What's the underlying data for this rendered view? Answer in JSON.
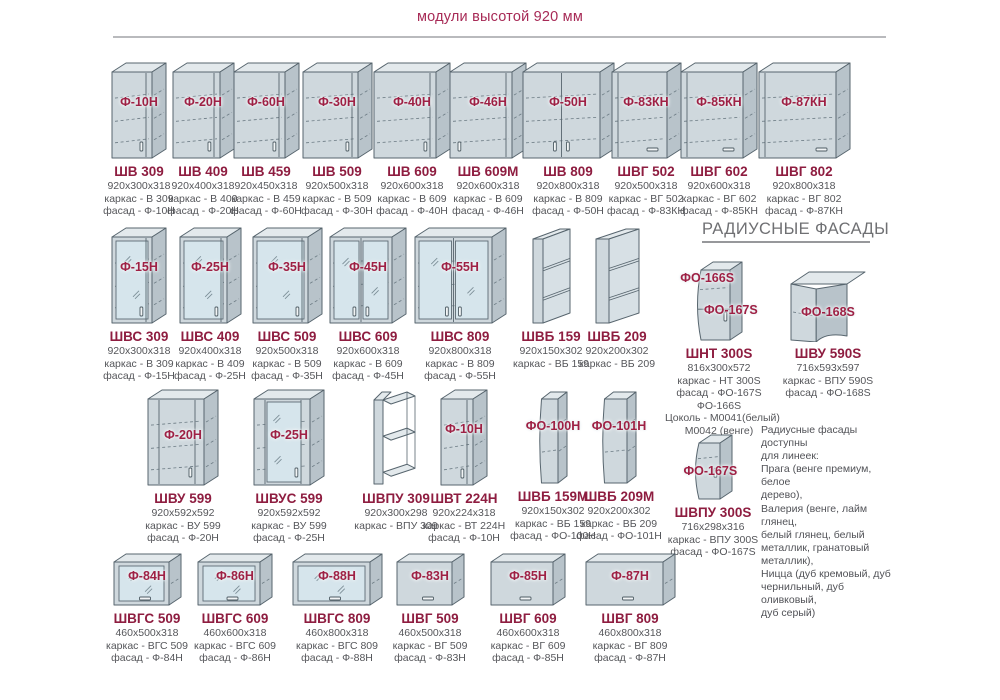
{
  "header": {
    "title": "модули высотой 920 мм"
  },
  "section": {
    "radius_heading": "РАДИУСНЫЕ ФАСАДЫ"
  },
  "colors": {
    "accent_maroon": "#8e1d40",
    "title_pink": "#a72a56",
    "spec_gray": "#55565a",
    "heading_gray": "#6f7073",
    "cabinet_fill": "#cfd8dd",
    "cabinet_side": "#b8c3ca",
    "glass_fill": "#d6e5ec"
  },
  "note": {
    "lines": [
      "Радиусные фасады доступны",
      "для линеек:",
      "Прага (венге премиум, белое",
      "дерево),",
      "Валерия (венге, лайм глянец,",
      "белый глянец, белый",
      "металлик, гранатовый",
      "металлик),",
      "Ницца (дуб кремовый, дуб",
      "чернильный, дуб оливковый,",
      "дуб серый)"
    ]
  },
  "modules": [
    {
      "code": "ШВ 309",
      "specs": [
        "920x300x318",
        "каркас - В 309",
        "фасад - Ф-10Н"
      ],
      "facades": [
        "Ф-10Н"
      ],
      "art": "cabinet-single-door"
    },
    {
      "code": "ШВ 409",
      "specs": [
        "920x400x318",
        "каркас - В 409",
        "фасад - Ф-20Н"
      ],
      "facades": [
        "Ф-20Н"
      ],
      "art": "cabinet-single-door"
    },
    {
      "code": "ШВ 459",
      "specs": [
        "920x450x318",
        "каркас - В 459",
        "фасад - Ф-60Н"
      ],
      "facades": [
        "Ф-60Н"
      ],
      "art": "cabinet-single-door"
    },
    {
      "code": "ШВ 509",
      "specs": [
        "920x500x318",
        "каркас - В 509",
        "фасад - Ф-30Н"
      ],
      "facades": [
        "Ф-30Н"
      ],
      "art": "cabinet-single-door"
    },
    {
      "code": "ШВ 609",
      "specs": [
        "920x600x318",
        "каркас - В 609",
        "фасад - Ф-40Н"
      ],
      "facades": [
        "Ф-40Н"
      ],
      "art": "cabinet-single-door"
    },
    {
      "code": "ШВ 609М",
      "specs": [
        "920x600x318",
        "каркас - В 609",
        "фасад - Ф-46Н"
      ],
      "facades": [
        "Ф-46Н"
      ],
      "art": "cabinet-single-door-left-handle"
    },
    {
      "code": "ШВ 809",
      "specs": [
        "920x800x318",
        "каркас - В 809",
        "фасад - Ф-50Н"
      ],
      "facades": [
        "Ф-50Н"
      ],
      "art": "cabinet-double-door"
    },
    {
      "code": "ШВГ 502",
      "specs": [
        "920x500x318",
        "каркас - ВГ 502",
        "фасад - Ф-83КН"
      ],
      "facades": [
        "Ф-83КН"
      ],
      "art": "cabinet-door-horizontal-handle"
    },
    {
      "code": "ШВГ 602",
      "specs": [
        "920x600x318",
        "каркас - ВГ 602",
        "фасад - Ф-85КН"
      ],
      "facades": [
        "Ф-85КН"
      ],
      "art": "cabinet-door-horizontal-handle"
    },
    {
      "code": "ШВГ 802",
      "specs": [
        "920x800x318",
        "каркас - ВГ 802",
        "фасад - Ф-87КН"
      ],
      "facades": [
        "Ф-87КН"
      ],
      "art": "cabinet-door-horizontal-handle"
    },
    {
      "code": "ШВС 309",
      "specs": [
        "920x300x318",
        "каркас - В 309",
        "фасад - Ф-15Н"
      ],
      "facades": [
        "Ф-15Н"
      ],
      "art": "cabinet-glass-door"
    },
    {
      "code": "ШВС 409",
      "specs": [
        "920x400x318",
        "каркас - В 409",
        "фасад - Ф-25Н"
      ],
      "facades": [
        "Ф-25Н"
      ],
      "art": "cabinet-glass-door"
    },
    {
      "code": "ШВС 509",
      "specs": [
        "920x500x318",
        "каркас - В 509",
        "фасад - Ф-35Н"
      ],
      "facades": [
        "Ф-35Н"
      ],
      "art": "cabinet-glass-door"
    },
    {
      "code": "ШВС 609",
      "specs": [
        "920x600x318",
        "каркас - В 609",
        "фасад - Ф-45Н"
      ],
      "facades": [
        "Ф-45Н"
      ],
      "art": "cabinet-glass-double-door"
    },
    {
      "code": "ШВС 809",
      "specs": [
        "920x800x318",
        "каркас - В 809",
        "фасад - Ф-55Н"
      ],
      "facades": [
        "Ф-55Н"
      ],
      "art": "cabinet-glass-double-door"
    },
    {
      "code": "ШВБ 159",
      "specs": [
        "920x150x302",
        "каркас - ВБ 159"
      ],
      "facades": [],
      "art": "cabinet-open-shelves"
    },
    {
      "code": "ШВБ 209",
      "specs": [
        "920x200x302",
        "каркас - ВБ 209"
      ],
      "facades": [],
      "art": "cabinet-open-shelves"
    },
    {
      "code": "ШНТ 300S",
      "specs": [
        "816x300x572",
        "каркас - НТ 300S",
        "фасад - ФО-167S",
        "ФО-166S",
        "Цоколь - М0041(белый)",
        "М0042 (венге)"
      ],
      "facades": [
        "ФО-166S",
        "ФО-167S"
      ],
      "art": "radius-end-cabinet-two-doors"
    },
    {
      "code": "ШВУ 590S",
      "specs": [
        "716x593x597",
        "каркас - ВПУ 590S",
        "фасад - ФО-168S"
      ],
      "facades": [
        "ФО-168S"
      ],
      "art": "radius-corner-cabinet"
    },
    {
      "code": "ШВУ 599",
      "specs": [
        "920x592x592",
        "каркас - ВУ 599",
        "фасад - Ф-20Н"
      ],
      "facades": [
        "Ф-20Н"
      ],
      "art": "corner-cabinet-door"
    },
    {
      "code": "ШВУС 599",
      "specs": [
        "920x592x592",
        "каркас - ВУ 599",
        "фасад - Ф-25Н"
      ],
      "facades": [
        "Ф-25Н"
      ],
      "art": "corner-cabinet-glass-door"
    },
    {
      "code": "ШВПУ 309",
      "specs": [
        "920x300x298",
        "каркас - ВПУ 309"
      ],
      "facades": [],
      "art": "corner-open-shelves"
    },
    {
      "code": "ШВТ 224Н",
      "specs": [
        "920x224x318",
        "каркас - ВТ 224Н",
        "фасад - Ф-10Н"
      ],
      "facades": [
        "Ф-10Н"
      ],
      "art": "cabinet-single-door"
    },
    {
      "code": "ШВБ 159М",
      "specs": [
        "920x150x302",
        "каркас - ВБ 159",
        "фасад - ФО-100Н"
      ],
      "facades": [
        "ФО-100Н"
      ],
      "art": "cabinet-radius-facade-narrow"
    },
    {
      "code": "ШВБ 209М",
      "specs": [
        "920x200x302",
        "каркас - ВБ 209",
        "фасад - ФО-101Н"
      ],
      "facades": [
        "ФО-101Н"
      ],
      "art": "cabinet-radius-facade-narrow"
    },
    {
      "code": "ШВПУ 300S",
      "specs": [
        "716x298x316",
        "каркас - ВПУ 300S",
        "фасад - ФО-167S"
      ],
      "facades": [
        "ФО-167S"
      ],
      "art": "radius-end-cabinet-small"
    },
    {
      "code": "ШВГС 509",
      "specs": [
        "460x500x318",
        "каркас - ВГС 509",
        "фасад - Ф-84Н"
      ],
      "facades": [
        "Ф-84Н"
      ],
      "art": "flap-cabinet-glass"
    },
    {
      "code": "ШВГС 609",
      "specs": [
        "460x600x318",
        "каркас - ВГС 609",
        "фасад - Ф-86Н"
      ],
      "facades": [
        "Ф-86Н"
      ],
      "art": "flap-cabinet-glass"
    },
    {
      "code": "ШВГС 809",
      "specs": [
        "460x800x318",
        "каркас - ВГС 809",
        "фасад - Ф-88Н"
      ],
      "facades": [
        "Ф-88Н"
      ],
      "art": "flap-cabinet-glass"
    },
    {
      "code": "ШВГ 509",
      "specs": [
        "460x500x318",
        "каркас - ВГ 509",
        "фасад - Ф-83Н"
      ],
      "facades": [
        "Ф-83Н"
      ],
      "art": "flap-cabinet-solid"
    },
    {
      "code": "ШВГ 609",
      "specs": [
        "460x600x318",
        "каркас - ВГ 609",
        "фасад - Ф-85Н"
      ],
      "facades": [
        "Ф-85Н"
      ],
      "art": "flap-cabinet-solid"
    },
    {
      "code": "ШВГ 809",
      "specs": [
        "460x800x318",
        "каркас - ВГ 809",
        "фасад - Ф-87Н"
      ],
      "facades": [
        "Ф-87Н"
      ],
      "art": "flap-cabinet-solid"
    }
  ]
}
